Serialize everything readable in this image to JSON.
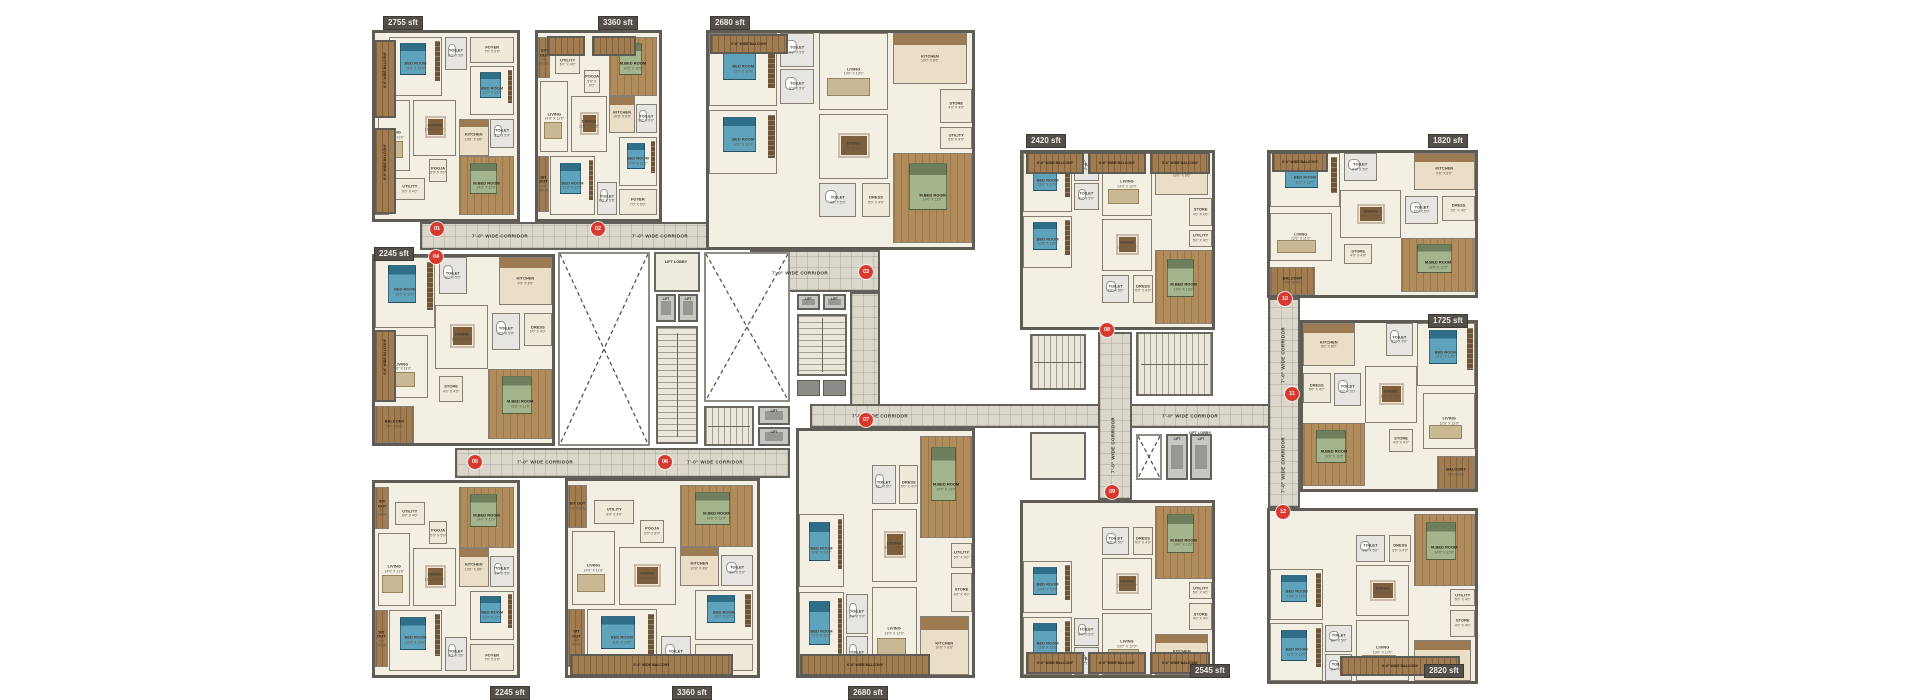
{
  "plan": {
    "description": "Typical cluster floor plan - two residential towers linked by corridors",
    "background": "#ffffff"
  },
  "labels": {
    "corridor": "7'-0\" WIDE CORRIDOR",
    "balcony": "6'-6\" WIDE BALCONY",
    "lift": "LIFT",
    "lift_lobby": "LIFT LOBBY",
    "area_unit": "sft"
  },
  "palette": {
    "wall": "#5f5c55",
    "floor": "#f4efe3",
    "corridor": "#dbd7cb",
    "wood": "#a07c50",
    "bed_blue": "#5ea3bb",
    "bed_green": "#a4b58d",
    "badge_red": "#d93a30",
    "area_badge_bg": "#544f49"
  },
  "units": [
    {
      "id": "01",
      "area": "2755 sft",
      "set": "L"
    },
    {
      "id": "02",
      "area": "3360 sft",
      "set": "L"
    },
    {
      "id": "03",
      "area": "2680 sft",
      "set": "W"
    },
    {
      "id": "04",
      "area": "2245 sft",
      "set": "S"
    },
    {
      "id": "05",
      "area": "2245 sft",
      "set": "L"
    },
    {
      "id": "06",
      "area": "3360 sft",
      "set": "L"
    },
    {
      "id": "07",
      "area": "2680 sft",
      "set": "W"
    },
    {
      "id": "08",
      "area": "2420 sft",
      "set": "W"
    },
    {
      "id": "09",
      "area": "2545 sft",
      "set": "W"
    },
    {
      "id": "10",
      "area": "1820 sft",
      "set": "S"
    },
    {
      "id": "11",
      "area": "1725 sft",
      "set": "S"
    },
    {
      "id": "12",
      "area": "2820 sft",
      "set": "W"
    }
  ],
  "room_sets": {
    "L": [
      {
        "name": "SIT OUT",
        "dim": "4'6\" WIDE"
      },
      {
        "name": "BED ROOM",
        "dim": "11'6\" X 13'0\""
      },
      {
        "name": "TOILET",
        "dim": "8'0\" X 5'6\""
      },
      {
        "name": "FOYER",
        "dim": "7'0\" X 5'0\""
      },
      {
        "name": "BED ROOM",
        "dim": "11'0\" X 12'0\""
      },
      {
        "name": "DINING",
        "dim": "12'6\" X 10'6\""
      },
      {
        "name": "KITCHEN",
        "dim": "10'6\" X 8'6\""
      },
      {
        "name": "TOILET",
        "dim": "8'0\" X 5'0\""
      },
      {
        "name": "LIVING",
        "dim": "14'0\" X 11'6\""
      },
      {
        "name": "SIT OUT",
        "dim": "4'6\" WIDE"
      },
      {
        "name": "M.BED ROOM",
        "dim": "14'6\" X 12'0\""
      },
      {
        "name": "POOJA",
        "dim": "5'0\" X 5'0\""
      },
      {
        "name": "UTILITY",
        "dim": "6'0\" X 4'0\""
      }
    ],
    "W": [
      {
        "name": "BED ROOM",
        "dim": "11'0\" X 12'6\""
      },
      {
        "name": "TOILET",
        "dim": "8'0\" X 5'0\""
      },
      {
        "name": "TOILET",
        "dim": "8'0\" X 5'0\""
      },
      {
        "name": "BED ROOM",
        "dim": "10'6\" X 12'0\""
      },
      {
        "name": "LIVING",
        "dim": "13'0\" X 12'0\""
      },
      {
        "name": "DINING",
        "dim": "12'0\" X 10'0\""
      },
      {
        "name": "KITCHEN",
        "dim": "10'0\" X 8'6\""
      },
      {
        "name": "STORE",
        "dim": "4'0\" X 4'0\""
      },
      {
        "name": "M.BED ROOM",
        "dim": "14'0\" X 12'6\""
      },
      {
        "name": "TOILET",
        "dim": "8'6\" X 5'0\""
      },
      {
        "name": "DRESS",
        "dim": "5'0\" X 4'0\""
      },
      {
        "name": "UTILITY",
        "dim": "5'0\" X 4'0\""
      }
    ],
    "S": [
      {
        "name": "BED ROOM",
        "dim": "11'0\" X 12'0\""
      },
      {
        "name": "TOILET",
        "dim": "8'0\" X 5'0\""
      },
      {
        "name": "KITCHEN",
        "dim": "9'6\" X 8'0\""
      },
      {
        "name": "LIVING",
        "dim": "12'6\" X 11'0\""
      },
      {
        "name": "DINING",
        "dim": "10'6\" X 10'0\""
      },
      {
        "name": "M.BED ROOM",
        "dim": "13'6\" X 11'6\""
      },
      {
        "name": "TOILET",
        "dim": "8'0\" X 5'0\""
      },
      {
        "name": "DRESS",
        "dim": "5'0\" X 4'0\""
      },
      {
        "name": "BALCONY",
        "dim": "5'0\" WIDE"
      },
      {
        "name": "STORE",
        "dim": "4'0\" X 4'0\""
      }
    ]
  }
}
